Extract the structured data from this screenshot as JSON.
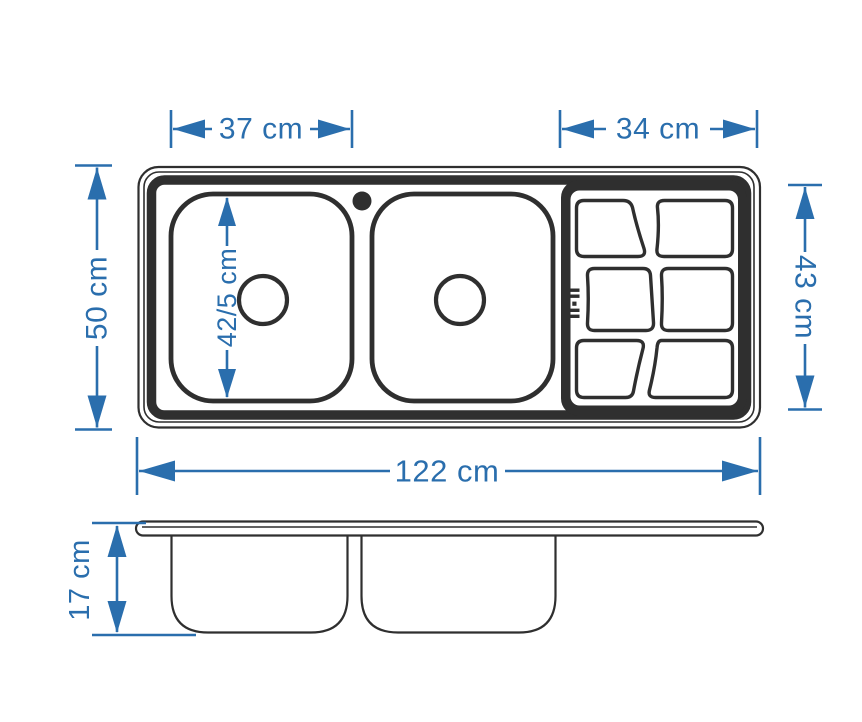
{
  "drawing": {
    "type": "sink-technical-drawing",
    "views": {
      "top_view": "double-bowl sink with right drainboard",
      "side_view": "section with two bowls under flat deck"
    },
    "dimensions": {
      "bowl_width": "37 cm",
      "drainboard_width": "34 cm",
      "sink_depth": "50 cm",
      "drainboard_depth": "43 cm",
      "bowl_inner_length": "42/5 cm",
      "total_length": "122 cm",
      "bowl_height": "17 cm"
    }
  },
  "colors": {
    "dimension_blue": "#2a6ead",
    "drawing_dark": "#2f2f2f",
    "background": "#ffffff"
  }
}
